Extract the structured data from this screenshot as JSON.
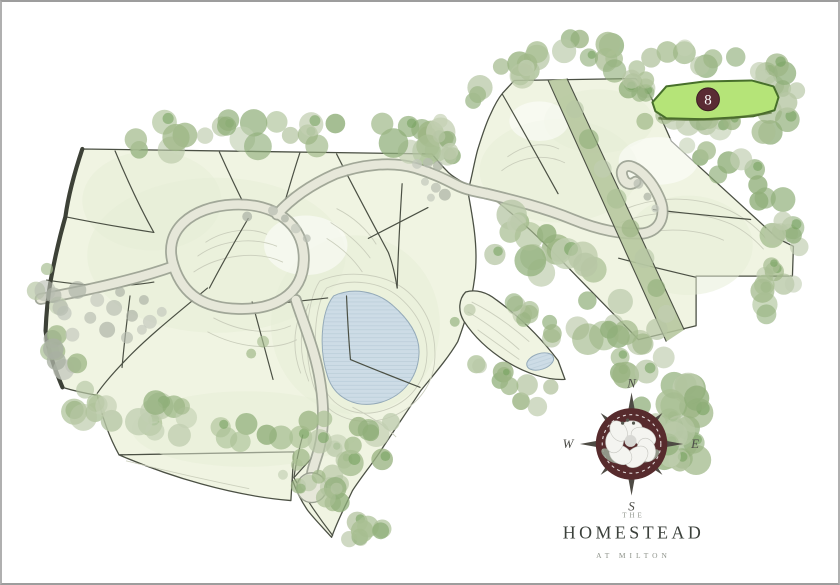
{
  "branding": {
    "prefix": "THE",
    "name": "HOMESTEAD",
    "tagline": "AT MILTON"
  },
  "compass": {
    "n": "N",
    "e": "E",
    "s": "S",
    "w": "W"
  },
  "highlighted_lot": {
    "number": "8"
  },
  "colors": {
    "frame": "#b0b0b0",
    "land_fill": "#f0f4e2",
    "land_line": "#4b5044",
    "land_edge_thick": "#3d4137",
    "road_fill": "#e6e7d9",
    "road_edge": "#9aa091",
    "band_fill": "#b5c69d",
    "pond_fill": "#cddce6",
    "pond_line": "#93a9b8",
    "pond_hatch": "#a9bfcd",
    "contour": "#c9cdbb",
    "wash": "#e6eed6",
    "lot8_fill": "#b5e478",
    "lot8_line": "#476f2b",
    "badge_fill": "#5a2b34",
    "badge_text": "#ffffff",
    "compass_circle": "#572b2d",
    "compass_metal": "#4e4b44",
    "compass_letter": "#4d4d48",
    "title_color": "#3b403b",
    "muted_color": "#8d9289",
    "tree_dark": "#74a05c",
    "tree_palette": [
      "#a9bf93",
      "#9cb584",
      "#b7c7a5",
      "#90af7a",
      "#c2cfb2"
    ],
    "gray_palette": [
      "#b6bcb0",
      "#a9b0a3",
      "#c2c7bc"
    ]
  }
}
